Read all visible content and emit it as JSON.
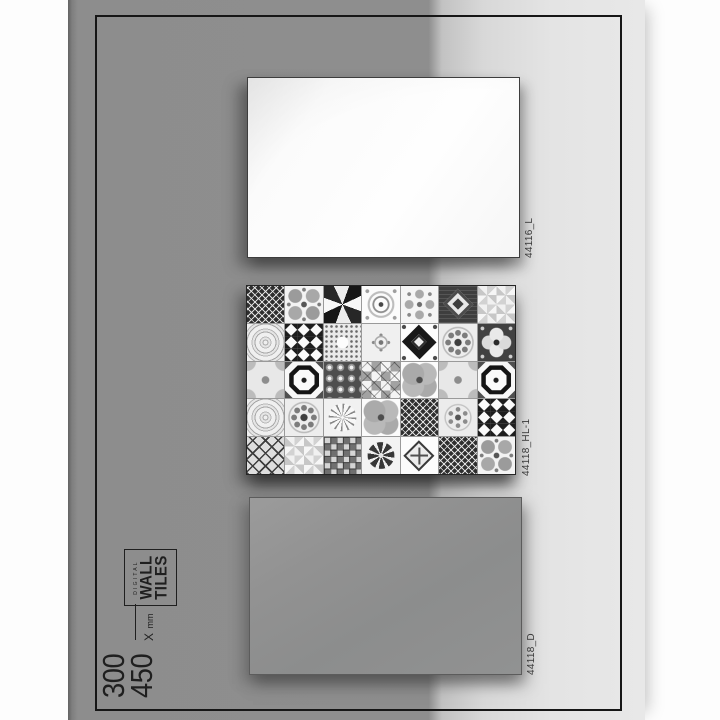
{
  "size_spec": {
    "width_mm": "300",
    "height_mm": "450",
    "separator": "X",
    "unit": "mm"
  },
  "brand_box": {
    "line_small": "DIGITAL",
    "line1": "WALL",
    "line2": "TILES"
  },
  "tiles": [
    {
      "code": "44116_L"
    },
    {
      "code": "44118_HL-1",
      "pattern_grid": [
        [
          "lattice-dark",
          "petals",
          "pinwheel-dark",
          "dot-medallion",
          "cross-floral",
          "ornate-dark",
          "pinwheel-light"
        ],
        [
          "rosette-lace",
          "diamond-grid",
          "dot-star",
          "ornate-light",
          "big-diamond",
          "rosette-ring",
          "dark-floral"
        ],
        [
          "quatrefoil",
          "octagon",
          "circle-grid",
          "check-cross",
          "clover",
          "quatrefoil",
          "octagon"
        ],
        [
          "rosette-lace",
          "rosette-ring",
          "starburst",
          "clover",
          "lattice-dark",
          "rosette-small",
          "diamond-grid"
        ],
        [
          "x-lattice",
          "pinwheel-light",
          "square-grid",
          "flower-circle",
          "diamond-cross",
          "lattice-dark",
          "petals"
        ]
      ]
    },
    {
      "code": "44118_D"
    }
  ],
  "colors": {
    "page_background": "#fdfdfd",
    "sheet_dark": "#8d8d8d",
    "sheet_light": "#e6e6e6",
    "frame_line": "#161616",
    "tile_light_face": "#fdfdfd",
    "tile_dark_face": "#919191",
    "label_text": "#383838",
    "spec_text": "#1f1f1f"
  }
}
